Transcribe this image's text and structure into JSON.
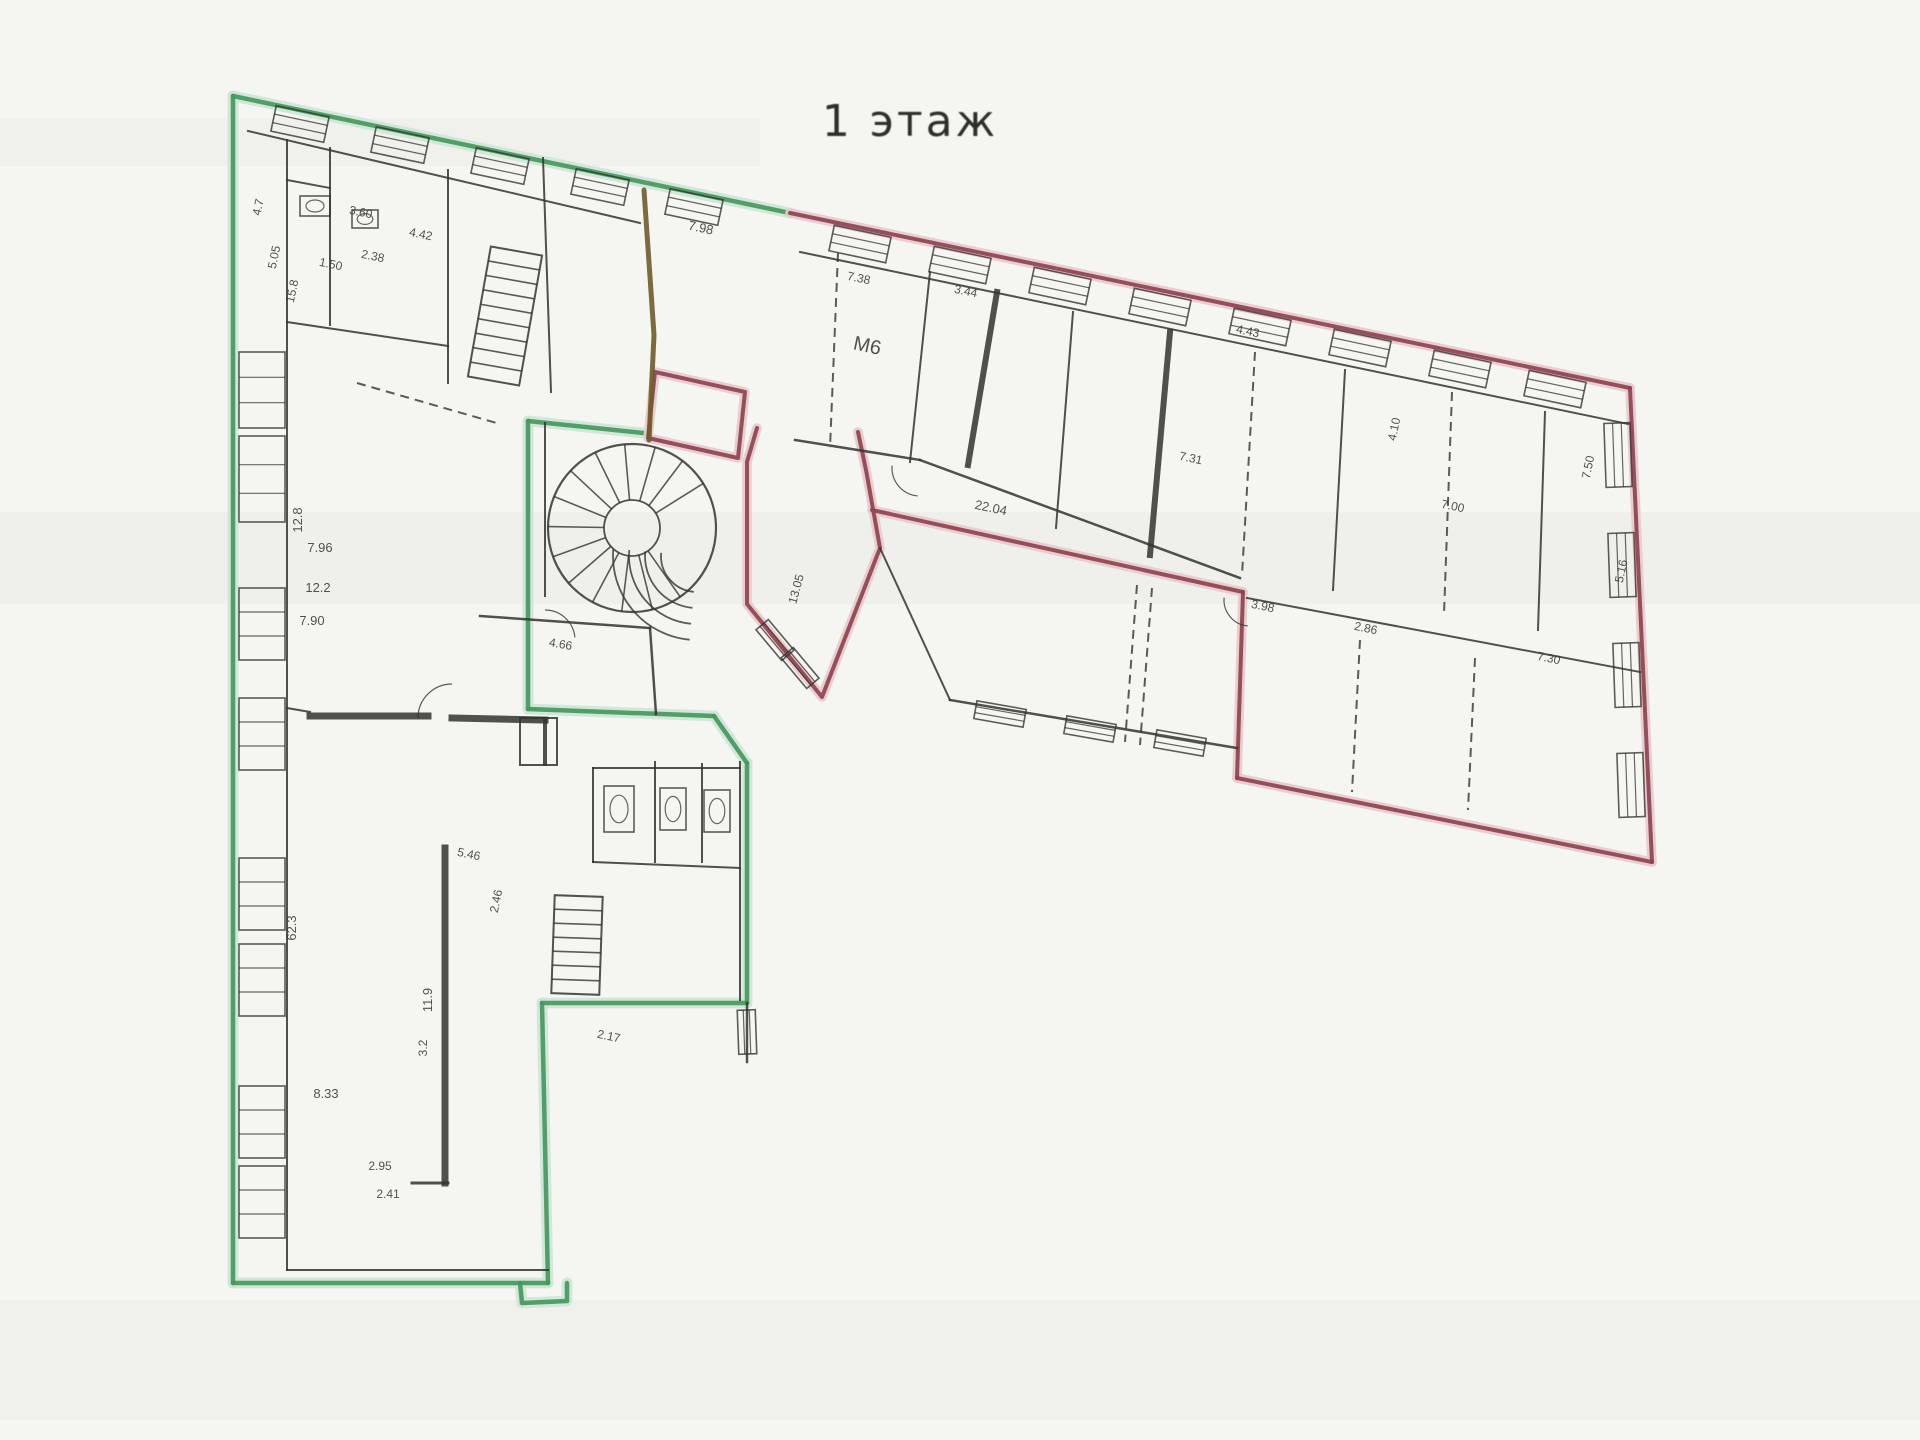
{
  "title": {
    "text": "1 этаж"
  },
  "colors": {
    "paper": "#f5f5f2",
    "green": "#47985f",
    "green_halo": "#cde6d4",
    "red": "#8e4350",
    "red_halo": "#e7cacd",
    "olive": "#6f5c2b",
    "wall": "#35352f",
    "label": "#3b3b36"
  },
  "plan": {
    "bands": [
      {
        "x": 0,
        "y": 512,
        "w": 1920,
        "h": 92,
        "a": 0.025
      },
      {
        "x": 0,
        "y": 118,
        "w": 760,
        "h": 48,
        "a": 0.02
      },
      {
        "x": 0,
        "y": 1300,
        "w": 1920,
        "h": 120,
        "a": 0.018
      }
    ],
    "green_paths": [
      [
        [
          233,
          96
        ],
        [
          790,
          213
        ]
      ],
      [
        [
          233,
          96
        ],
        [
          233,
          1283
        ]
      ],
      [
        [
          233,
          1283
        ],
        [
          548,
          1283
        ]
      ],
      [
        [
          548,
          1283
        ],
        [
          542,
          1003
        ]
      ],
      [
        [
          542,
          1003
        ],
        [
          747,
          1003
        ]
      ],
      [
        [
          747,
          1003
        ],
        [
          747,
          763
        ]
      ],
      [
        [
          747,
          763
        ],
        [
          714,
          716
        ]
      ],
      [
        [
          714,
          716
        ],
        [
          528,
          709
        ]
      ],
      [
        [
          528,
          709
        ],
        [
          528,
          421
        ]
      ],
      [
        [
          528,
          421
        ],
        [
          643,
          433
        ]
      ],
      [
        [
          520,
          1283
        ],
        [
          522,
          1303
        ],
        [
          567,
          1301
        ],
        [
          567,
          1283
        ]
      ]
    ],
    "red_paths": [
      [
        [
          790,
          213
        ],
        [
          1630,
          388
        ]
      ],
      [
        [
          1630,
          388
        ],
        [
          1652,
          862
        ]
      ],
      [
        [
          1652,
          862
        ],
        [
          1237,
          778
        ]
      ],
      [
        [
          1237,
          778
        ],
        [
          1243,
          592
        ]
      ],
      [
        [
          1243,
          592
        ],
        [
          872,
          510
        ]
      ],
      [
        [
          757,
          428
        ],
        [
          747,
          462
        ],
        [
          747,
          604
        ],
        [
          822,
          697
        ],
        [
          880,
          548
        ],
        [
          866,
          470
        ],
        [
          858,
          432
        ]
      ],
      [
        [
          655,
          372
        ],
        [
          745,
          392
        ],
        [
          738,
          458
        ],
        [
          648,
          438
        ],
        [
          655,
          372
        ]
      ]
    ],
    "olive_paths": [
      [
        [
          644,
          190
        ],
        [
          654,
          335
        ],
        [
          649,
          440
        ]
      ]
    ],
    "walls": [
      [
        287,
        140,
        287,
        1270,
        2
      ],
      [
        248,
        131,
        640,
        223,
        2
      ],
      [
        800,
        252,
        1628,
        424,
        2
      ],
      [
        287,
        1270,
        548,
        1270,
        2
      ],
      [
        330,
        148,
        330,
        325,
        2
      ],
      [
        287,
        322,
        448,
        346,
        2
      ],
      [
        448,
        170,
        448,
        346,
        2
      ],
      [
        543,
        158,
        551,
        392,
        2
      ],
      [
        310,
        716,
        428,
        716,
        7
      ],
      [
        452,
        718,
        545,
        720,
        7
      ],
      [
        545,
        720,
        545,
        764,
        4
      ],
      [
        445,
        848,
        445,
        1183,
        7
      ],
      [
        412,
        1183,
        448,
        1183,
        3
      ],
      [
        480,
        616,
        650,
        628,
        2.5
      ],
      [
        650,
        628,
        656,
        714,
        2.5
      ],
      [
        593,
        768,
        740,
        768,
        2
      ],
      [
        593,
        768,
        593,
        862,
        2
      ],
      [
        655,
        762,
        655,
        862,
        2
      ],
      [
        702,
        764,
        702,
        862,
        2
      ],
      [
        740,
        762,
        740,
        1000,
        2
      ],
      [
        593,
        862,
        740,
        868,
        2
      ],
      [
        747,
        1003,
        747,
        1062,
        2.5
      ],
      [
        545,
        423,
        545,
        596,
        2
      ],
      [
        920,
        460,
        1240,
        578,
        2.5
      ],
      [
        795,
        440,
        920,
        460,
        2.5
      ],
      [
        1247,
        598,
        1640,
        672,
        2
      ],
      [
        997,
        292,
        968,
        465,
        6
      ],
      [
        1170,
        332,
        1150,
        555,
        6
      ],
      [
        1073,
        312,
        1056,
        528,
        2
      ],
      [
        1345,
        370,
        1333,
        590,
        2
      ],
      [
        1545,
        412,
        1538,
        630,
        2
      ],
      [
        950,
        700,
        1237,
        748,
        2.5
      ],
      [
        880,
        548,
        950,
        700,
        2
      ],
      [
        287,
        708,
        310,
        712,
        2
      ],
      [
        448,
        346,
        448,
        383,
        2
      ],
      [
        287,
        180,
        330,
        188,
        2
      ],
      [
        930,
        272,
        910,
        462,
        2
      ]
    ],
    "dashed_walls": [
      [
        357,
        383,
        500,
        424
      ],
      [
        838,
        253,
        830,
        448
      ],
      [
        1255,
        352,
        1242,
        575
      ],
      [
        1452,
        392,
        1444,
        614
      ],
      [
        1137,
        585,
        1125,
        742
      ],
      [
        1152,
        588,
        1140,
        745
      ],
      [
        1360,
        640,
        1352,
        792
      ],
      [
        1475,
        658,
        1468,
        810
      ]
    ],
    "boxes": [
      {
        "x": 520,
        "y": 718,
        "w": 37,
        "h": 47
      }
    ],
    "windows": [
      {
        "x": 262,
        "y": 390,
        "w": 46,
        "h": 76,
        "r": 0
      },
      {
        "x": 262,
        "y": 479,
        "w": 46,
        "h": 86,
        "r": 0
      },
      {
        "x": 262,
        "y": 624,
        "w": 46,
        "h": 72,
        "r": 0
      },
      {
        "x": 262,
        "y": 734,
        "w": 46,
        "h": 72,
        "r": 0
      },
      {
        "x": 262,
        "y": 894,
        "w": 46,
        "h": 72,
        "r": 0
      },
      {
        "x": 262,
        "y": 980,
        "w": 46,
        "h": 72,
        "r": 0
      },
      {
        "x": 262,
        "y": 1122,
        "w": 46,
        "h": 72,
        "r": 0
      },
      {
        "x": 262,
        "y": 1202,
        "w": 46,
        "h": 72,
        "r": 0
      },
      {
        "x": 300,
        "y": 124,
        "w": 54,
        "h": 26,
        "r": 12
      },
      {
        "x": 400,
        "y": 145,
        "w": 54,
        "h": 26,
        "r": 12
      },
      {
        "x": 500,
        "y": 166,
        "w": 54,
        "h": 26,
        "r": 12
      },
      {
        "x": 600,
        "y": 187,
        "w": 54,
        "h": 26,
        "r": 12
      },
      {
        "x": 694,
        "y": 207,
        "w": 54,
        "h": 26,
        "r": 12
      },
      {
        "x": 860,
        "y": 244,
        "w": 58,
        "h": 26,
        "r": 12
      },
      {
        "x": 960,
        "y": 265,
        "w": 58,
        "h": 26,
        "r": 12
      },
      {
        "x": 1060,
        "y": 286,
        "w": 58,
        "h": 26,
        "r": 12
      },
      {
        "x": 1160,
        "y": 307,
        "w": 58,
        "h": 26,
        "r": 12
      },
      {
        "x": 1260,
        "y": 327,
        "w": 58,
        "h": 26,
        "r": 12
      },
      {
        "x": 1360,
        "y": 348,
        "w": 58,
        "h": 26,
        "r": 12
      },
      {
        "x": 1460,
        "y": 369,
        "w": 58,
        "h": 26,
        "r": 12
      },
      {
        "x": 1555,
        "y": 389,
        "w": 58,
        "h": 26,
        "r": 12
      },
      {
        "x": 1618,
        "y": 455,
        "w": 64,
        "h": 26,
        "r": 88
      },
      {
        "x": 1622,
        "y": 565,
        "w": 64,
        "h": 26,
        "r": 88
      },
      {
        "x": 1627,
        "y": 675,
        "w": 64,
        "h": 26,
        "r": 88
      },
      {
        "x": 1631,
        "y": 785,
        "w": 64,
        "h": 26,
        "r": 88
      },
      {
        "x": 1000,
        "y": 714,
        "w": 50,
        "h": 18,
        "r": 10
      },
      {
        "x": 1090,
        "y": 729,
        "w": 50,
        "h": 18,
        "r": 10
      },
      {
        "x": 1180,
        "y": 743,
        "w": 50,
        "h": 18,
        "r": 10
      },
      {
        "x": 775,
        "y": 640,
        "w": 40,
        "h": 16,
        "r": 50
      },
      {
        "x": 800,
        "y": 668,
        "w": 40,
        "h": 16,
        "r": 50
      },
      {
        "x": 747,
        "y": 1032,
        "w": 44,
        "h": 18,
        "r": 88
      }
    ],
    "stairs": [
      {
        "x": 479,
        "y": 250,
        "w": 52,
        "h": 132,
        "steps": 9,
        "r": 10
      },
      {
        "x": 553,
        "y": 896,
        "w": 48,
        "h": 98,
        "steps": 7,
        "r": 2
      }
    ],
    "spiral": {
      "cx": 632,
      "cy": 528,
      "rOuter": 84,
      "rInner": 28,
      "a0": 55,
      "a1": 330,
      "step": 21
    },
    "fan": {
      "cx": 697,
      "cy": 556,
      "radii": [
        36,
        52,
        68,
        84
      ],
      "a0": 95,
      "a1": 185
    },
    "door_arcs": [
      {
        "cx": 452,
        "cy": 718,
        "r": 34,
        "a0": 180,
        "a1": 270
      },
      {
        "cx": 920,
        "cy": 468,
        "r": 28,
        "a0": 95,
        "a1": 185
      },
      {
        "cx": 1250,
        "cy": 600,
        "r": 26,
        "a0": 95,
        "a1": 185
      },
      {
        "cx": 545,
        "cy": 640,
        "r": 30,
        "a0": 270,
        "a1": 355
      }
    ],
    "fixtures": [
      {
        "x": 604,
        "y": 786,
        "w": 30,
        "h": 46
      },
      {
        "x": 660,
        "y": 788,
        "w": 26,
        "h": 42
      },
      {
        "x": 704,
        "y": 790,
        "w": 26,
        "h": 42
      },
      {
        "x": 300,
        "y": 196,
        "w": 30,
        "h": 20
      },
      {
        "x": 352,
        "y": 210,
        "w": 26,
        "h": 18
      }
    ],
    "labels": [
      {
        "t": "4.7",
        "x": 262,
        "y": 208,
        "r": -78,
        "s": 12
      },
      {
        "t": "5.05",
        "x": 278,
        "y": 258,
        "r": -78,
        "s": 12
      },
      {
        "t": "15.8",
        "x": 296,
        "y": 292,
        "r": -78,
        "s": 12
      },
      {
        "t": "3.60",
        "x": 360,
        "y": 216,
        "r": 12,
        "s": 12
      },
      {
        "t": "2.38",
        "x": 372,
        "y": 260,
        "r": 12,
        "s": 12
      },
      {
        "t": "1.50",
        "x": 330,
        "y": 268,
        "r": 12,
        "s": 12
      },
      {
        "t": "4.42",
        "x": 420,
        "y": 238,
        "r": 12,
        "s": 12
      },
      {
        "t": "7.98",
        "x": 700,
        "y": 232,
        "r": 12,
        "s": 13
      },
      {
        "t": "7.38",
        "x": 858,
        "y": 282,
        "r": 12,
        "s": 12
      },
      {
        "t": "3.44",
        "x": 965,
        "y": 295,
        "r": 12,
        "s": 12
      },
      {
        "t": "М6",
        "x": 866,
        "y": 352,
        "r": 12,
        "s": 20
      },
      {
        "t": "12.8",
        "x": 302,
        "y": 520,
        "r": -90,
        "s": 13
      },
      {
        "t": "7.96",
        "x": 320,
        "y": 552,
        "r": 0,
        "s": 13
      },
      {
        "t": "12.2",
        "x": 318,
        "y": 592,
        "r": 0,
        "s": 13
      },
      {
        "t": "7.90",
        "x": 312,
        "y": 625,
        "r": 0,
        "s": 13
      },
      {
        "t": "62.3",
        "x": 296,
        "y": 928,
        "r": -90,
        "s": 13
      },
      {
        "t": "11.9",
        "x": 432,
        "y": 1000,
        "r": -90,
        "s": 13
      },
      {
        "t": "8.33",
        "x": 326,
        "y": 1098,
        "r": 0,
        "s": 13
      },
      {
        "t": "2.95",
        "x": 380,
        "y": 1170,
        "r": 0,
        "s": 12
      },
      {
        "t": "2.41",
        "x": 388,
        "y": 1198,
        "r": 0,
        "s": 12
      },
      {
        "t": "3.2",
        "x": 427,
        "y": 1048,
        "r": -90,
        "s": 12
      },
      {
        "t": "5.46",
        "x": 468,
        "y": 858,
        "r": 12,
        "s": 12
      },
      {
        "t": "2.46",
        "x": 500,
        "y": 902,
        "r": -78,
        "s": 12
      },
      {
        "t": "4.66",
        "x": 560,
        "y": 648,
        "r": 10,
        "s": 12
      },
      {
        "t": "2.17",
        "x": 608,
        "y": 1040,
        "r": 12,
        "s": 12
      },
      {
        "t": "22.04",
        "x": 990,
        "y": 512,
        "r": 12,
        "s": 13
      },
      {
        "t": "13.05",
        "x": 800,
        "y": 590,
        "r": -75,
        "s": 12
      },
      {
        "t": "7.31",
        "x": 1190,
        "y": 462,
        "r": 12,
        "s": 12
      },
      {
        "t": "4.43",
        "x": 1247,
        "y": 335,
        "r": 12,
        "s": 12
      },
      {
        "t": "4.10",
        "x": 1398,
        "y": 430,
        "r": -78,
        "s": 12
      },
      {
        "t": "7.00",
        "x": 1452,
        "y": 510,
        "r": 12,
        "s": 12
      },
      {
        "t": "7.50",
        "x": 1592,
        "y": 468,
        "r": -78,
        "s": 12
      },
      {
        "t": "5.16",
        "x": 1625,
        "y": 572,
        "r": -78,
        "s": 12
      },
      {
        "t": "3.98",
        "x": 1262,
        "y": 610,
        "r": 12,
        "s": 12
      },
      {
        "t": "2.86",
        "x": 1365,
        "y": 632,
        "r": 12,
        "s": 12
      },
      {
        "t": "7.30",
        "x": 1548,
        "y": 662,
        "r": 12,
        "s": 12
      }
    ]
  }
}
